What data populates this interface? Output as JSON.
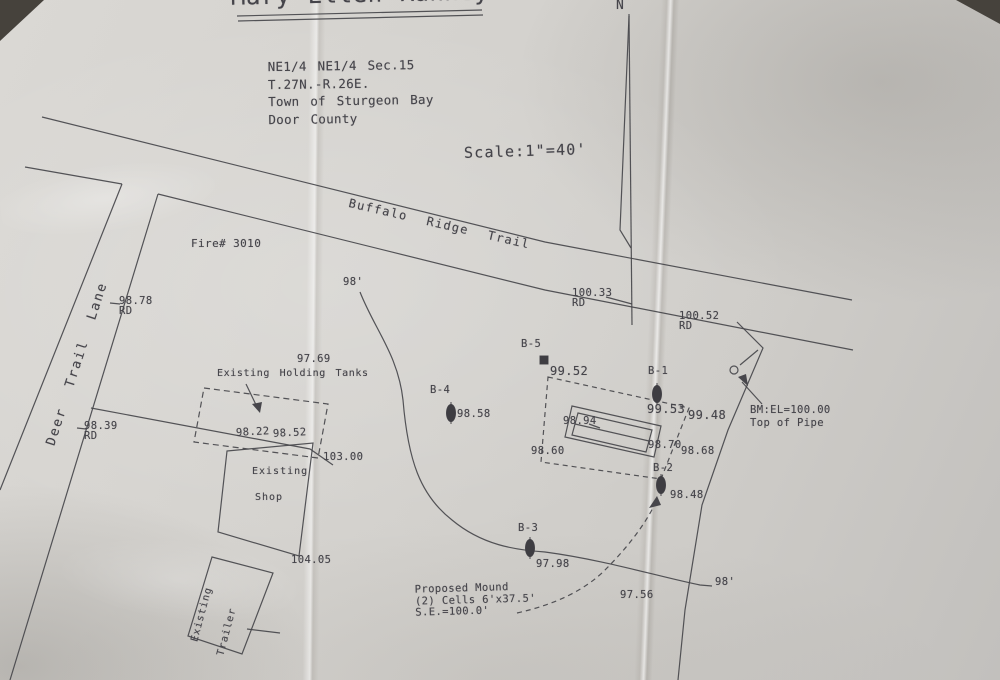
{
  "document": {
    "title": "Mary Ellen Rahney"
  },
  "legal_description": {
    "line1": "NE1/4 NE1/4 Sec.15",
    "line2": "T.27N.-R.26E.",
    "line3": "Town of Sturgeon Bay",
    "line4": "Door County"
  },
  "map_info": {
    "scale": "Scale:1\"=40'",
    "north": "N"
  },
  "roads": {
    "main_road": "Buffalo Ridge Trail",
    "side_road": "Deer Trail Lane",
    "fire_number": "Fire# 3010",
    "rd_abbrev": "RD"
  },
  "road_elevations": {
    "deer_north": "98.78",
    "deer_south": "98.39",
    "buffalo_west": "100.33",
    "buffalo_east": "100.52"
  },
  "benchmark": {
    "line1": "BM:EL=100.00",
    "line2": "Top of Pipe"
  },
  "borings": [
    {
      "id": "B-5",
      "elev": ""
    },
    {
      "id": "B-4",
      "elev": "98.58"
    },
    {
      "id": "B-1",
      "elev": "99.53"
    },
    {
      "id": "B-2",
      "elev": "98.48"
    },
    {
      "id": "B-3",
      "elev": "97.98"
    }
  ],
  "spot_elevations": {
    "e9952": "99.52",
    "e9948": "99.48",
    "e9894": "98.94",
    "e9870": "98.70",
    "e9868": "98.68",
    "e9860": "98.60",
    "e9756": "97.56",
    "e9769": "97.69"
  },
  "structures": {
    "holding_tanks": "Existing Holding Tanks",
    "shop_line1": "Existing",
    "shop_line2": "Shop",
    "shop_elev": "103.00",
    "shop_corner_elev": "104.05",
    "trailer_line1": "Existing",
    "trailer_line2": "Trailer",
    "drive_elev_a": "98.22",
    "drive_elev_b": "98.52"
  },
  "proposed_mound": {
    "line1": "Proposed Mound",
    "line2": "(2) Cells 6'x37.5'",
    "line3": "S.E.=100.0'"
  },
  "contour": {
    "top_label": "98'",
    "right_label": "98'"
  },
  "colors": {
    "ink": "#45444a",
    "paper": "#d3d1cd",
    "background": "#46423c"
  }
}
